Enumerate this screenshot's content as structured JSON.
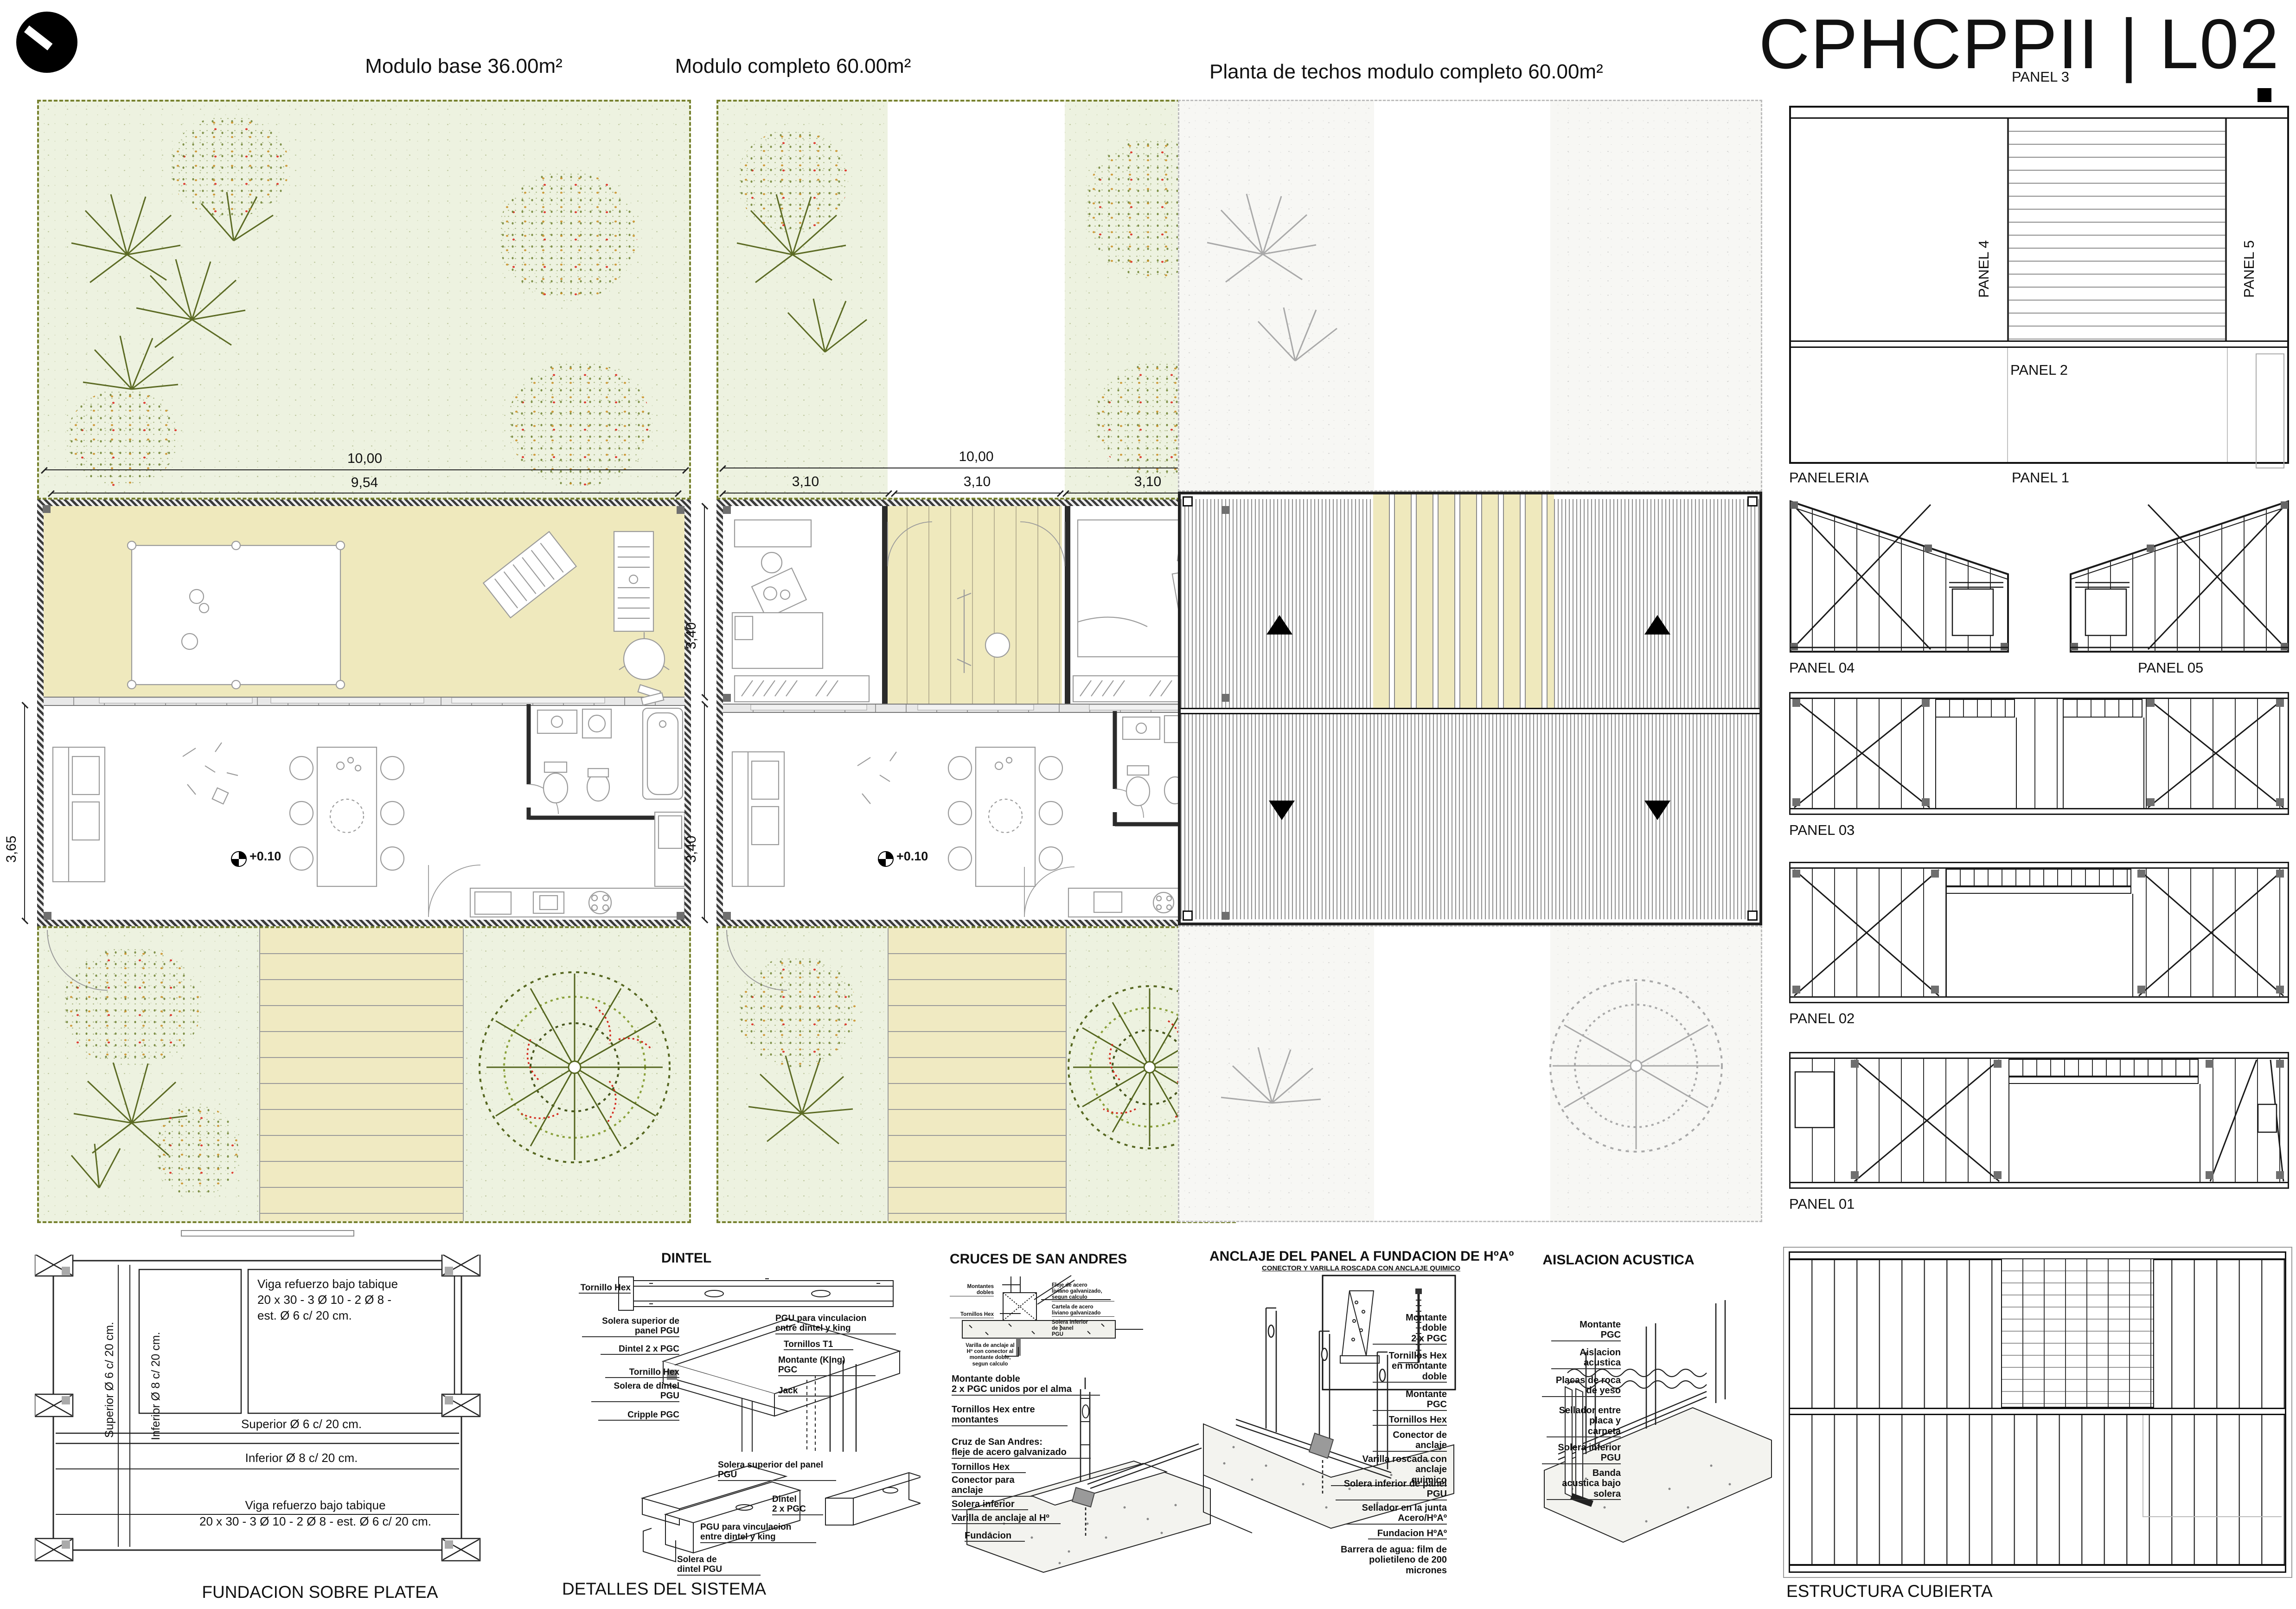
{
  "sheet": {
    "title": "CPHCPPII | L02",
    "logo": "clock-logo"
  },
  "plans": {
    "base": {
      "title": "Modulo base 36.00m²",
      "dim_total": "10,00",
      "dim_inner": "9,54",
      "dim_side": "3,65",
      "level": "+0.10"
    },
    "completo": {
      "title": "Modulo completo 60.00m²",
      "dim_total": "10,00",
      "dim_mod": [
        "3,10",
        "3,10",
        "3,10"
      ],
      "dim_side": [
        "3,40",
        "3,40"
      ],
      "level": "+0.10"
    },
    "techos": {
      "title": "Planta de techos modulo completo 60.00m²"
    }
  },
  "paneleria": {
    "label": "PANELERIA",
    "panel3": "PANEL 3",
    "panel4": "PANEL 4",
    "panel5": "PANEL 5",
    "panel2": "PANEL 2",
    "panel1": "PANEL 1",
    "panel04": "PANEL 04",
    "panel05": "PANEL 05",
    "panel03": "PANEL 03",
    "panel02": "PANEL 02",
    "panel01": "PANEL 01"
  },
  "estructura": {
    "title": "ESTRUCTURA CUBIERTA"
  },
  "fundacion": {
    "title": "FUNDACION SOBRE PLATEA",
    "superior_v": "Superior Ø 6 c/ 20 cm.",
    "inferior_v": "Inferior Ø 8 c/ 20 cm.",
    "nota_sup": "Viga refuerzo bajo tabique\n20 x 30 - 3 Ø 10 - 2 Ø 8 -\nest. Ø 6 c/ 20 cm.",
    "superior_h": "Superior Ø 6 c/ 20 cm.",
    "inferior_h": "Inferior Ø 8 c/ 20 cm.",
    "nota_inf": "Viga refuerzo bajo tabique\n20 x 30 - 3 Ø 10 - 2 Ø 8 - est. Ø 6 c/ 20 cm."
  },
  "dintel": {
    "title": "DINTEL",
    "footer": "DETALLES DEL SISTEMA",
    "tornillo_top": "Tornillo Hex",
    "solera_sup": "Solera superior de\npanel PGU",
    "dintel1": "Dintel 2 x PGC",
    "tornillo": "Tornillo Hex",
    "solera_dintel": "Solera de dintel\nPGU",
    "cripple": "Cripple PGC",
    "pgu_vinc": "PGU para vinculacion\nentre dintel y king",
    "tornillos_t1": "Tornillos T1",
    "montante_king": "Montante (King)\nPGC",
    "jack": "Jack",
    "solera_sup2": "Solera superior del panel\nPGU",
    "dintel2": "Dintel\n2 x PGC",
    "pgu_vinc2": "PGU para vinculacion\nentre dintel y king",
    "solera_dintel2": "Solera de\ndintel PGU"
  },
  "cruces": {
    "title": "CRUCES DE SAN ANDRES",
    "montantes_dobles": "Montantes\ndobles",
    "tornillos_hex_t": "Tornillos Hex",
    "fleje": "Fleje de acero\nliviano galvanizado,\nsegun calculo",
    "cartela": "Cartela de acero\nliviano galvanizado",
    "solera_inf_panel": "Solera inferior\nde panel\nPGU",
    "varilla_nota": "Varilla de anclaje al\nHº con conector al\nmontante doble,\nsegun calculo",
    "montante_doble": "Montante doble\n2 x PGC unidos por el alma",
    "tornillos_montantes": "Tornillos Hex entre\nmontantes",
    "cruz": "Cruz de San Andres:\nfleje de acero galvanizado",
    "tornillos_hex": "Tornillos Hex",
    "conector": "Conector para\nanclaje",
    "solera_inferior": "Solera inferior",
    "varilla": "Varilla de anclaje al Hº",
    "fundacion": "Fundacion"
  },
  "anclaje": {
    "title": "ANCLAJE DEL PANEL A FUNDACION DE HºAº",
    "subtitle": "CONECTOR Y VARILLA ROSCADA CON ANCLAJE QUIMICO",
    "montante_doble": "Montante\ndoble\n2 x PGC",
    "tornillos_doble": "Tornillos Hex\nen montante\ndoble",
    "montante": "Montante\nPGC",
    "tornillos": "Tornillos Hex",
    "conector": "Conector de\nanclaje",
    "varilla": "Varilla roscada con anclaje\nquimico",
    "solera": "Solera inferior de panel\nPGU",
    "sellador": "Sellador en la junta\nAcero/HºAº",
    "fundacion": "Fundacion HºAº",
    "barrera": "Barrera de agua: film de\npolietileno de 200 micrones"
  },
  "aislacion": {
    "title": "AISLACION ACUSTICA",
    "montante": "Montante\nPGC",
    "aislacion": "Aislacion\nacustica",
    "placas": "Placas de roca\nde yeso",
    "sellador": "Sellador entre\nplaca y\ncarpeta",
    "solera": "Solera inferior\nPGU",
    "banda": "Banda\nacustica bajo\nsolera"
  }
}
